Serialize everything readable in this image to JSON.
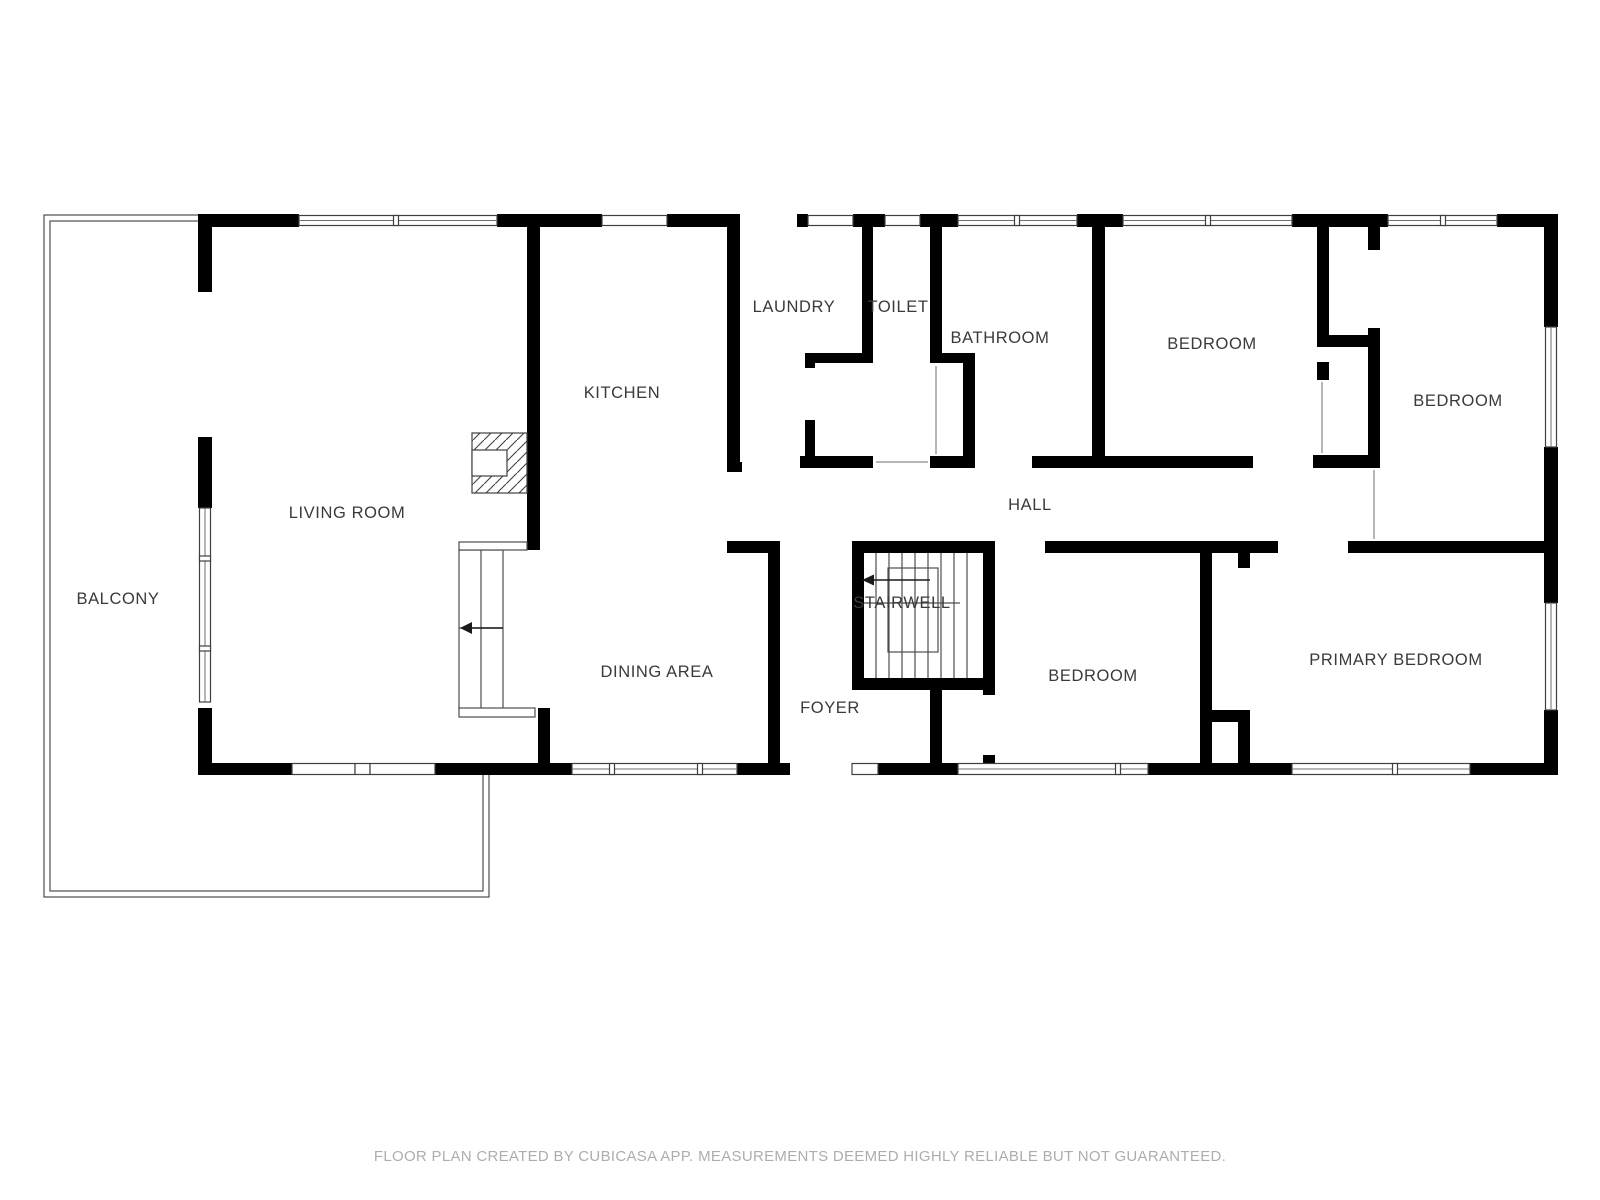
{
  "page": {
    "background": "#ffffff"
  },
  "colors": {
    "wall": "#000000",
    "thin_line": "#4d4d4d",
    "room_label": "#3a3a3a",
    "footer_text": "#adadad"
  },
  "rooms": [
    {
      "id": "balcony",
      "label": "BALCONY"
    },
    {
      "id": "living-room",
      "label": "LIVING ROOM"
    },
    {
      "id": "kitchen",
      "label": "KITCHEN"
    },
    {
      "id": "dining-area",
      "label": "DINING AREA"
    },
    {
      "id": "laundry",
      "label": "LAUNDRY"
    },
    {
      "id": "toilet",
      "label": "TOILET"
    },
    {
      "id": "bathroom",
      "label": "BATHROOM"
    },
    {
      "id": "bedroom-top",
      "label": "BEDROOM"
    },
    {
      "id": "bedroom-right",
      "label": "BEDROOM"
    },
    {
      "id": "hall",
      "label": "HALL"
    },
    {
      "id": "stairwell",
      "label": "STAIRWELL"
    },
    {
      "id": "bedroom-middle",
      "label": "BEDROOM"
    },
    {
      "id": "foyer",
      "label": "FOYER"
    },
    {
      "id": "primary-bedroom",
      "label": "PRIMARY BEDROOM"
    }
  ],
  "icons": [
    {
      "name": "stair-direction-arrow-dining",
      "direction": "left"
    },
    {
      "name": "stair-direction-arrow-stairwell",
      "direction": "left"
    }
  ],
  "footer": {
    "text": "FLOOR PLAN CREATED BY CUBICASA APP. MEASUREMENTS DEEMED HIGHLY RELIABLE BUT NOT GUARANTEED."
  }
}
